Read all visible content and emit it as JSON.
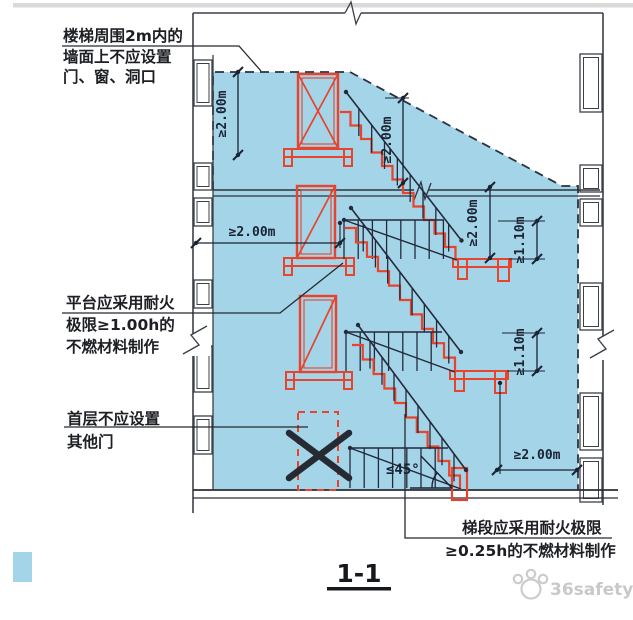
{
  "colors": {
    "zone_fill": "#a3d4e8",
    "stair_red": "#e8432c",
    "line_dark": "#242a3a",
    "wall_dark": "#3c4048",
    "dim_color": "#1b2334",
    "watermark_gray": "#c9c9c9",
    "divider_gray": "#d9d9d9"
  },
  "annotations": {
    "zone": {
      "line1": "楼梯周围2m内的",
      "line2": "墙面上不应设置",
      "line3": "门、窗、洞口"
    },
    "platform": {
      "line1": "平台应采用耐火",
      "line2": "极限≥1.00h的",
      "line3": "不燃材料制作"
    },
    "first_floor": {
      "line1": "首层不应设置",
      "line2": "其他门"
    },
    "flight": {
      "line1": "梯段应采用耐火极限",
      "line2": "≥0.25h的不燃材料制作"
    }
  },
  "dimensions": {
    "zone_top_vertical": "≥2.00m",
    "headroom": "≥2.00m",
    "storey_clear": "≥2.00m",
    "railing_upper": "≥1.10m",
    "railing_lower": "≥1.10m",
    "side_clear": "≥2.00m",
    "bottom_clear": "≥2.00m",
    "max_angle": "≤45°"
  },
  "section_label": "1-1",
  "watermark": "36safety"
}
